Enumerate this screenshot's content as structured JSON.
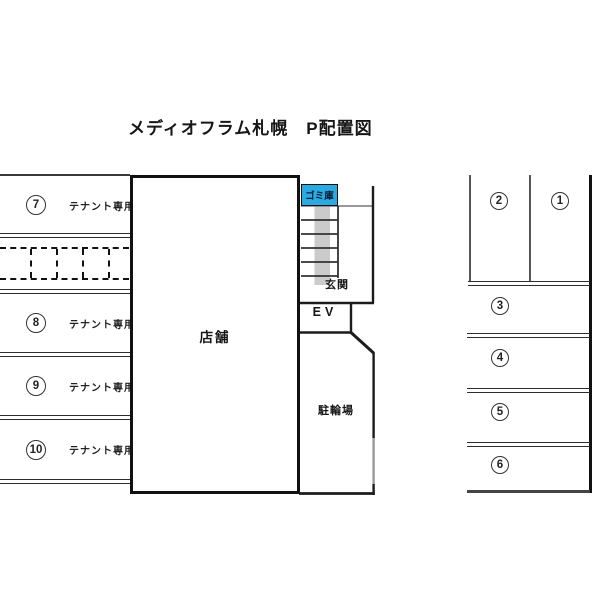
{
  "title": "メディオフラム札幌　P配置図",
  "colors": {
    "line": "#3a3a3a",
    "thick_border": "#111111",
    "garbage_box_blue": "#29abe2",
    "stair_stripe_gray": "#cbcbcb",
    "gate_gray": "#9a9a9a"
  },
  "left_parking": {
    "rows": [
      {
        "num": "7",
        "label": "テナント専用"
      },
      {
        "num": "8",
        "label": "テナント専用"
      },
      {
        "num": "9",
        "label": "テナント専用"
      },
      {
        "num": "10",
        "label": "テナント専用"
      }
    ]
  },
  "building": {
    "store_label": "店舗",
    "garbage_label": "ゴミ庫",
    "entrance_label": "玄関",
    "elevator_label": "EV",
    "bicycle_label": "駐輪場"
  },
  "right_parking": {
    "top_stalls": [
      {
        "num": "2"
      },
      {
        "num": "1"
      }
    ],
    "rows": [
      {
        "num": "3"
      },
      {
        "num": "4"
      },
      {
        "num": "5"
      },
      {
        "num": "6"
      }
    ]
  }
}
